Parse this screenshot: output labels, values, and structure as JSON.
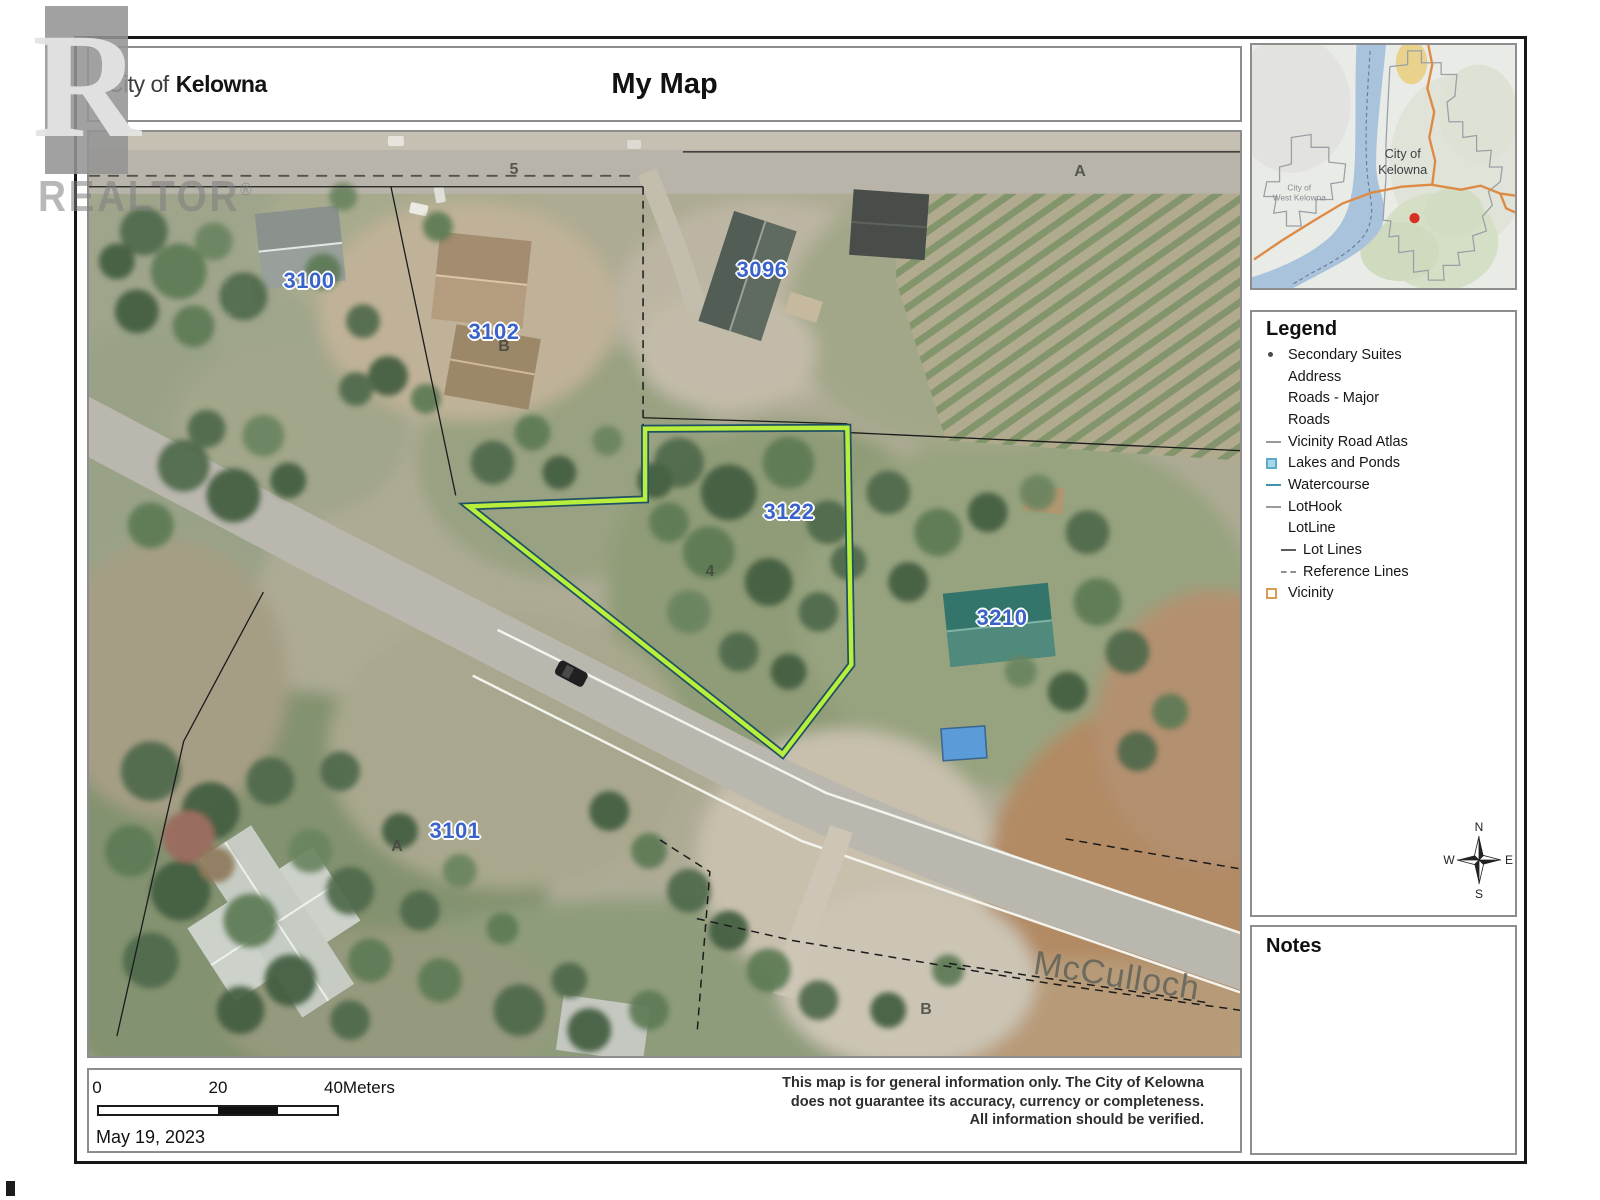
{
  "colors": {
    "highlight_green": "#b9ef3c",
    "lot_line_teal": "#1e5164",
    "address_label_blue": "#3a63c9",
    "inset_road_orange": "#dd8a45",
    "inset_lake_blue": "#a9c3dc",
    "inset_marker_red": "#d93025"
  },
  "watermark": {
    "block_letter": "R",
    "word": "REALTOR",
    "registered": "®"
  },
  "header": {
    "org_light": "City of",
    "org_bold": "Kelowna",
    "title": "My Map"
  },
  "inset_map": {
    "city_label_line1": "City of",
    "city_label_line2": "Kelowna",
    "west_city_line1": "City of",
    "west_city_line2": "West Kelowna"
  },
  "legend": {
    "title": "Legend",
    "items": [
      {
        "label": "Secondary Suites",
        "symbol": "dot"
      },
      {
        "label": "Address",
        "symbol": "none"
      },
      {
        "label": "Roads - Major",
        "symbol": "none"
      },
      {
        "label": "Roads",
        "symbol": "none"
      },
      {
        "label": "Vicinity Road Atlas",
        "symbol": "gray-line"
      },
      {
        "label": "Lakes and Ponds",
        "symbol": "blue-square"
      },
      {
        "label": "Watercourse",
        "symbol": "teal-line"
      },
      {
        "label": "LotHook",
        "symbol": "gray-line"
      },
      {
        "label": "LotLine",
        "symbol": "none"
      },
      {
        "label": "Lot Lines",
        "symbol": "dark-line-indented"
      },
      {
        "label": "Reference Lines",
        "symbol": "dashed-line-indented"
      },
      {
        "label": "Vicinity",
        "symbol": "orange-square"
      }
    ]
  },
  "compass": {
    "north": "N",
    "east": "E",
    "south": "S",
    "west": "W"
  },
  "notes": {
    "title": "Notes"
  },
  "map": {
    "address_labels": [
      {
        "text": "3100"
      },
      {
        "text": "3102"
      },
      {
        "text": "3096"
      },
      {
        "text": "3122"
      },
      {
        "text": "3210"
      },
      {
        "text": "3101"
      }
    ],
    "small_labels": [
      {
        "text": "5"
      },
      {
        "text": "A"
      },
      {
        "text": "B"
      },
      {
        "text": "4"
      },
      {
        "text": "A"
      },
      {
        "text": "B"
      }
    ],
    "road_label": "McCulloch"
  },
  "footer": {
    "scale_labels": {
      "zero": "0",
      "mid": "20",
      "max": "40Meters"
    },
    "date": "May 19, 2023",
    "disclaimer_lines": [
      "This map is for general information only. The City of Kelowna",
      "does not guarantee its accuracy, currency or completeness.",
      "All information should be verified."
    ]
  }
}
